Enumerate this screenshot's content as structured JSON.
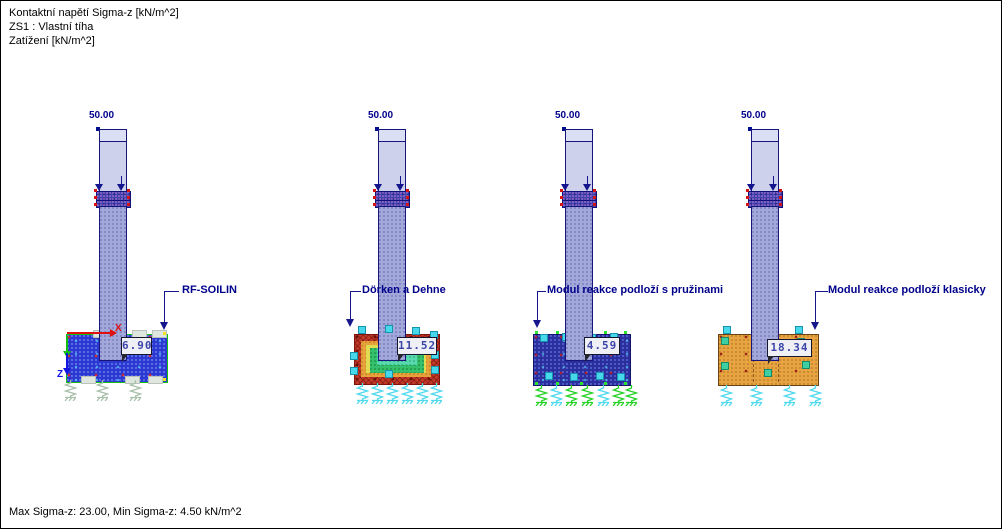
{
  "header": {
    "line1": "Kontaktní napětí Sigma-z [kN/m^2]",
    "line2": "ZS1 : Vlastní tíha",
    "line3": "Zatížení [kN/m^2]"
  },
  "footer": {
    "summary": "Max Sigma-z: 23.00, Min Sigma-z: 4.50 kN/m^2"
  },
  "axes": {
    "x": "X",
    "z": "Z"
  },
  "models": [
    {
      "name": "RF-SOILIN",
      "load": "50.00",
      "value": "6.90"
    },
    {
      "name": "Dörken a Dehne",
      "load": "50.00",
      "value": "11.52"
    },
    {
      "name": "Modul reakce podloží s pružinami",
      "load": "50.00",
      "value": "4.59"
    },
    {
      "name": "Modul reakce podloží klasicky",
      "load": "50.00",
      "value": "18.34"
    }
  ],
  "colors": {
    "label_navy": "#00008b",
    "value_text": "#3c44a8",
    "soilin_fill": "#2c38cf",
    "dorken_outer": "#c43a29",
    "dorken_mid": "#e8a23c",
    "dorken_inner": "#58d9ae",
    "springs_fill": "#2b2f9e",
    "classic_fill": "#e7a440",
    "axis_x": "#e01010",
    "axis_z": "#1515e0"
  }
}
